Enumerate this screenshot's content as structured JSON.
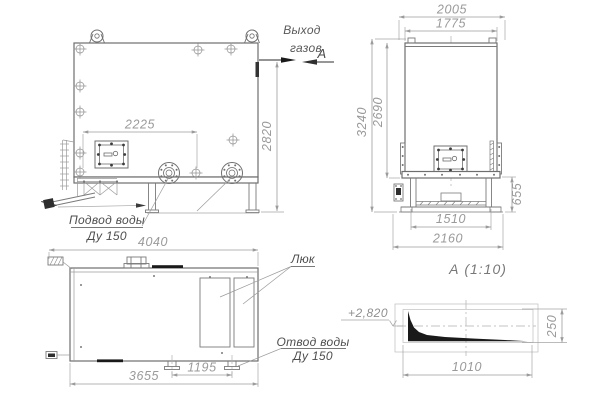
{
  "drawing": {
    "front_view": {
      "gas_outlet_label_line1": "Выход",
      "gas_outlet_label_line2": "газов",
      "section_cut_label": "А",
      "dim_nozzle_span": "2225",
      "dim_height": "2820",
      "water_inlet_label_line1": "Подвод воды",
      "water_inlet_label_line2": "Ду 150"
    },
    "side_view": {
      "dim_overall_width": "2005",
      "dim_body_width": "1775",
      "dim_overall_height": "3240",
      "dim_body_height": "2690",
      "dim_base_height": "655",
      "dim_frame_width": "1510",
      "dim_base_width": "2160"
    },
    "plan_view": {
      "dim_overall_length": "4040",
      "dim_body_length": "3655",
      "dim_nozzle_spacing": "1195",
      "hatch_label": "Люк",
      "water_outlet_label_line1": "Отвод воды",
      "water_outlet_label_line2": "Ду 150"
    },
    "section_view": {
      "title": "А  (1:10)",
      "level_mark": "+2,820",
      "dim_length": "1010",
      "dim_height": "250"
    },
    "colors": {
      "outline": "#6e6e6e",
      "dimension": "#9a9a9a",
      "label": "#4d4d4d",
      "solid_fill": "#1a1a1a",
      "background": "#ffffff"
    }
  }
}
